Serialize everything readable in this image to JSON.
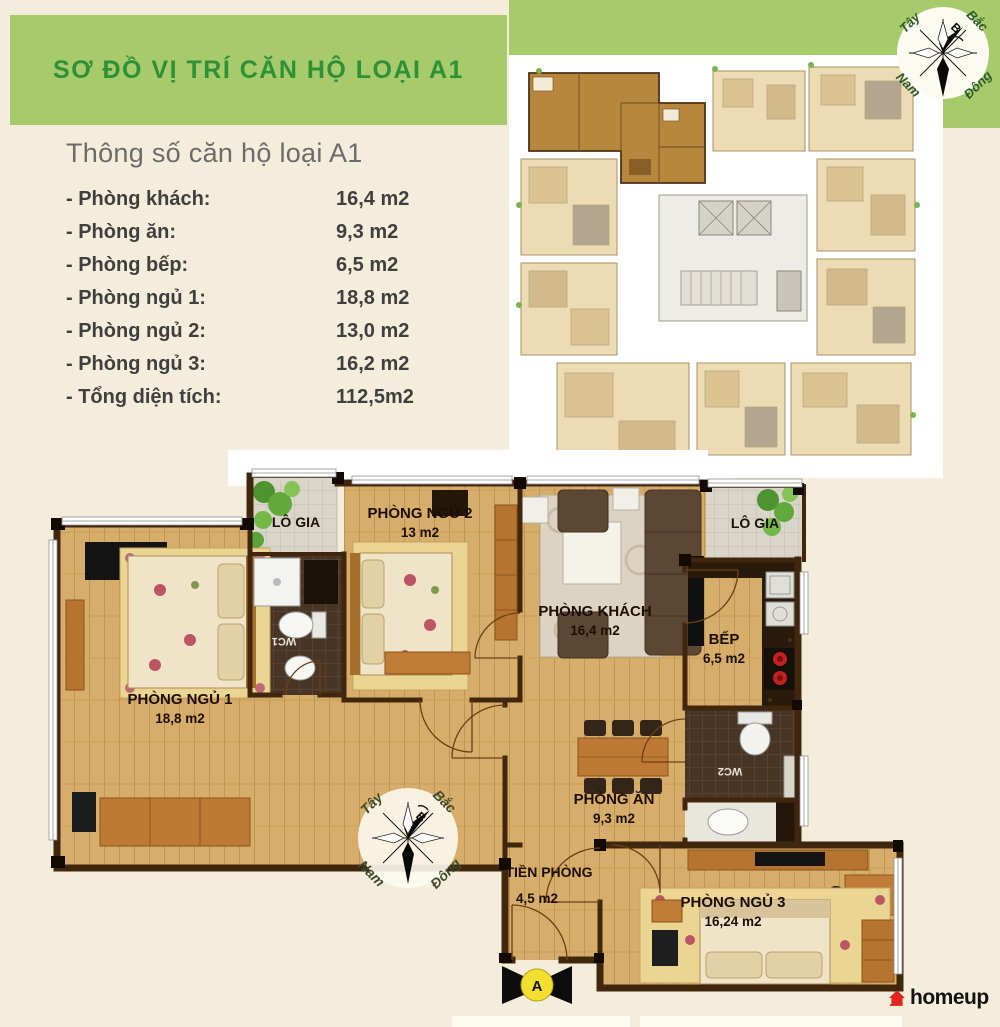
{
  "banner": {
    "title": "SƠ ĐỒ VỊ TRÍ CĂN HỘ LOẠI A1"
  },
  "specs": {
    "title": "Thông số căn hộ loại A1",
    "rows": [
      {
        "label": "- Phòng khách:",
        "value": "16,4 m2"
      },
      {
        "label": "- Phòng ăn:",
        "value": "9,3 m2"
      },
      {
        "label": "- Phòng bếp:",
        "value": "6,5 m2"
      },
      {
        "label": "- Phòng ngủ 1:",
        "value": "18,8 m2"
      },
      {
        "label": "- Phòng ngủ 2:",
        "value": "13,0 m2"
      },
      {
        "label": "- Phòng ngủ 3:",
        "value": "16,2 m2"
      },
      {
        "label": "- Tổng diện tích:",
        "value": "112,5m2"
      }
    ]
  },
  "compass": {
    "west": "Tây",
    "north": "Bắc",
    "south": "Nam",
    "east": "Đông",
    "north_mark": "B"
  },
  "floorplan": {
    "bedroom1": {
      "name": "PHÒNG NGỦ 1",
      "area": "18,8 m2"
    },
    "bedroom2": {
      "name": "PHÒNG NGỦ 2",
      "area": "13 m2"
    },
    "bedroom3": {
      "name": "PHÒNG NGỦ 3",
      "area": "16,24 m2"
    },
    "living": {
      "name": "PHÒNG KHÁCH",
      "area": "16,4 m2"
    },
    "kitchen": {
      "name": "BẾP",
      "area": "6,5 m2"
    },
    "dining": {
      "name": "PHÒNG ĂN",
      "area": "9,3 m2"
    },
    "hall": {
      "name": "TIỀN PHÒNG",
      "area": "4,5 m2"
    },
    "loggia1": {
      "name": "LÔ GIA"
    },
    "loggia2": {
      "name": "LÔ GIA"
    },
    "wc1": {
      "name": "WC1"
    },
    "wc2": {
      "name": "WC2"
    },
    "entrance": {
      "label": "A"
    }
  },
  "logo": {
    "name": "homeup"
  },
  "colors": {
    "banner_green": "#a7ca6b",
    "banner_text_green": "#2f9137",
    "logo_red": "#e2251c",
    "wall_brown": "#40260d",
    "wood_floor": "#d6ae6c",
    "page_cream": "#f4eddb"
  }
}
